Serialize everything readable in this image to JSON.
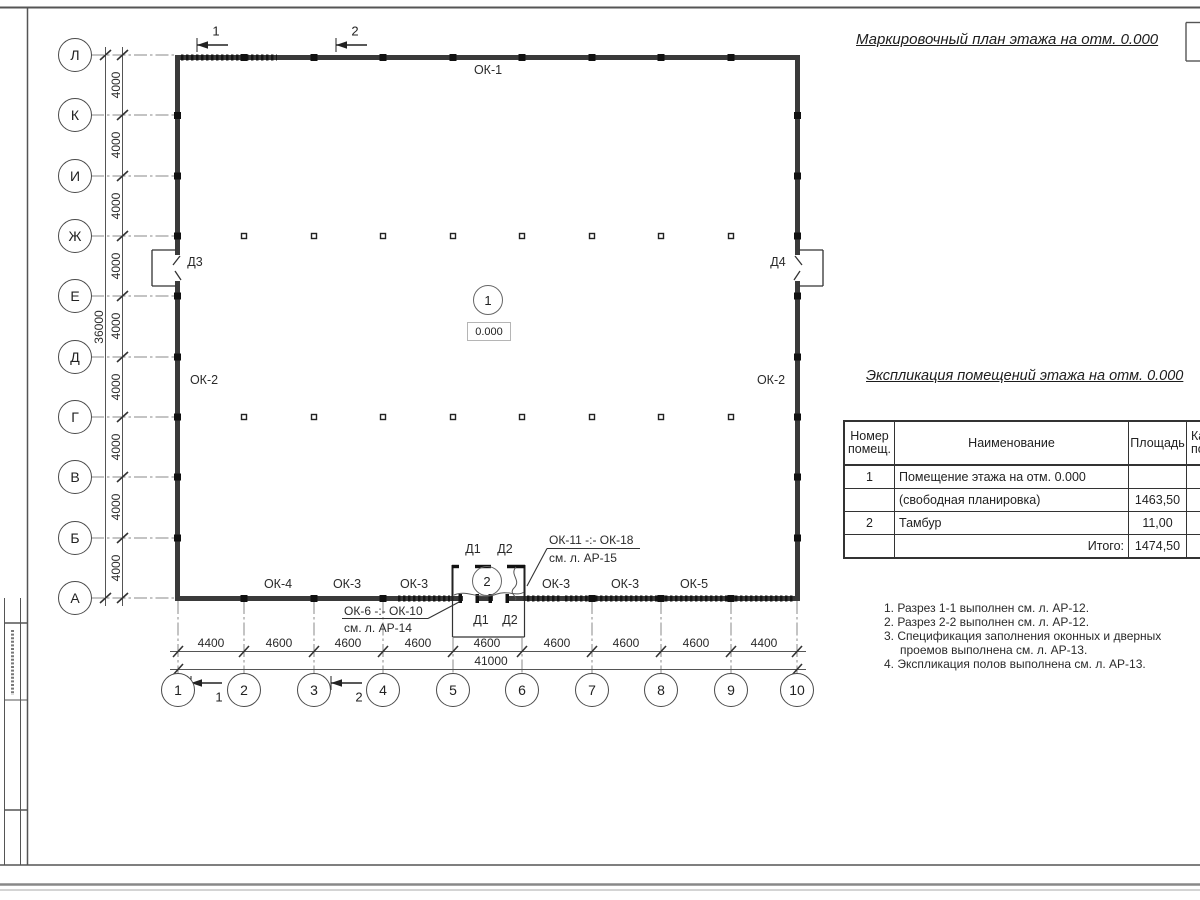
{
  "titles": {
    "plan": "Маркировочный план этажа на отм. 0.000",
    "table": "Экспликация помещений этажа на отм. 0.000"
  },
  "axes": {
    "rows": [
      "Л",
      "К",
      "И",
      "Ж",
      "Е",
      "Д",
      "Г",
      "В",
      "Б",
      "А"
    ],
    "cols": [
      "1",
      "2",
      "3",
      "4",
      "5",
      "6",
      "7",
      "8",
      "9",
      "10"
    ]
  },
  "dimensions": {
    "row_segments": [
      "4000",
      "4000",
      "4000",
      "4000",
      "4000",
      "4000",
      "4000",
      "4000",
      "4000"
    ],
    "row_total": "36000",
    "col_segments": [
      "4400",
      "4600",
      "4600",
      "4600",
      "4600",
      "4600",
      "4600",
      "4600",
      "4400"
    ],
    "col_total": "41000"
  },
  "marks": {
    "section_top_1": "1",
    "section_top_2": "2",
    "section_bottom_1": "1",
    "section_bottom_2": "2"
  },
  "windows": {
    "top": "ОК-1",
    "left": "ОК-2",
    "right": "ОК-2",
    "bottom": [
      "ОК-4",
      "ОК-3",
      "ОК-3",
      "ОК-3",
      "ОК-3",
      "ОК-5"
    ]
  },
  "doors": {
    "left": "Д3",
    "right": "Д4",
    "tambour_top": [
      "Д1",
      "Д2"
    ],
    "tambour_bottom": [
      "Д1",
      "Д2"
    ]
  },
  "rooms": {
    "room1": {
      "number": "1",
      "elevation": "0.000"
    },
    "room2": {
      "number": "2"
    }
  },
  "callouts": {
    "windows_top": {
      "line1": "ОК-11 -:- ОК-18",
      "line2": "см. л. АР-15"
    },
    "windows_bottom": {
      "line1": "ОК-6 -:- ОК-10",
      "line2": "см. л. АР-14"
    }
  },
  "table": {
    "header": {
      "col1_line1": "Номер",
      "col1_line2": "помещ.",
      "col2": "Наименование",
      "col3": "Площадь",
      "col4_line1": "Ка",
      "col4_line2": "по"
    },
    "rows": [
      {
        "num": "1",
        "name": "Помещение этажа на отм. 0.000",
        "area": ""
      },
      {
        "num": "",
        "name": "(свободная планировка)",
        "area": "1463,50"
      },
      {
        "num": "2",
        "name": "Тамбур",
        "area": "11,00"
      },
      {
        "num": "",
        "name": "Итого:",
        "area": "1474,50"
      }
    ]
  },
  "notes": [
    "1. Разрез 1-1 выполнен см. л. АР-12.",
    "2. Разрез 2-2 выполнен см. л. АР-12.",
    "3. Спецификация заполнения оконных и дверных",
    "проемов выполнена см. л. АР-13.",
    "4. Экспликация полов выполнена см. л. АР-13."
  ]
}
